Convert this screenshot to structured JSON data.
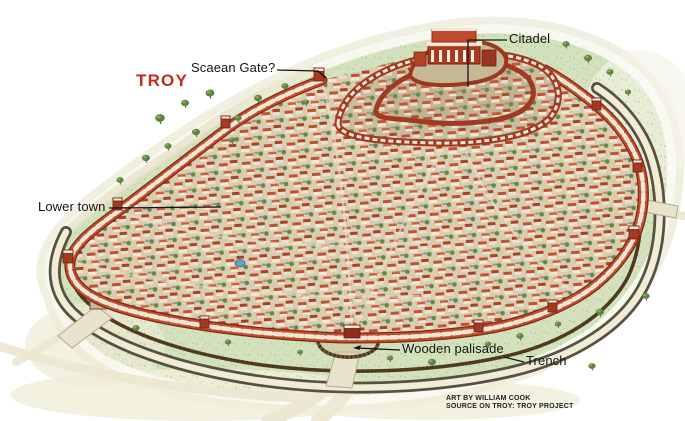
{
  "illustration": {
    "title": "TROY",
    "labels": {
      "citadel": "Citadel",
      "scaean_gate": "Scaean Gate?",
      "lower_town": "Lower town",
      "wooden_palisade": "Wooden palisade",
      "trench": "Trench"
    },
    "credits": [
      "ART BY WILLIAM COOK",
      "SOURCE ON TROY: TROY PROJECT"
    ],
    "colors": {
      "title_red": "#c52a1d",
      "label_text": "#151515",
      "wall_orange": "#c14f2e",
      "wall_dark_red": "#7e2a16",
      "wall_panel_white": "#efe7d4",
      "roof_red": "#bf4a2b",
      "house_white": "#f1e9d6",
      "terrain_green": "#d3e2bd",
      "trench_dark": "#57523f",
      "palisade_brown": "#7a5a36",
      "road_cream": "#ece5cf",
      "tree_green": "#5e8342",
      "background": "#ffffff"
    }
  }
}
